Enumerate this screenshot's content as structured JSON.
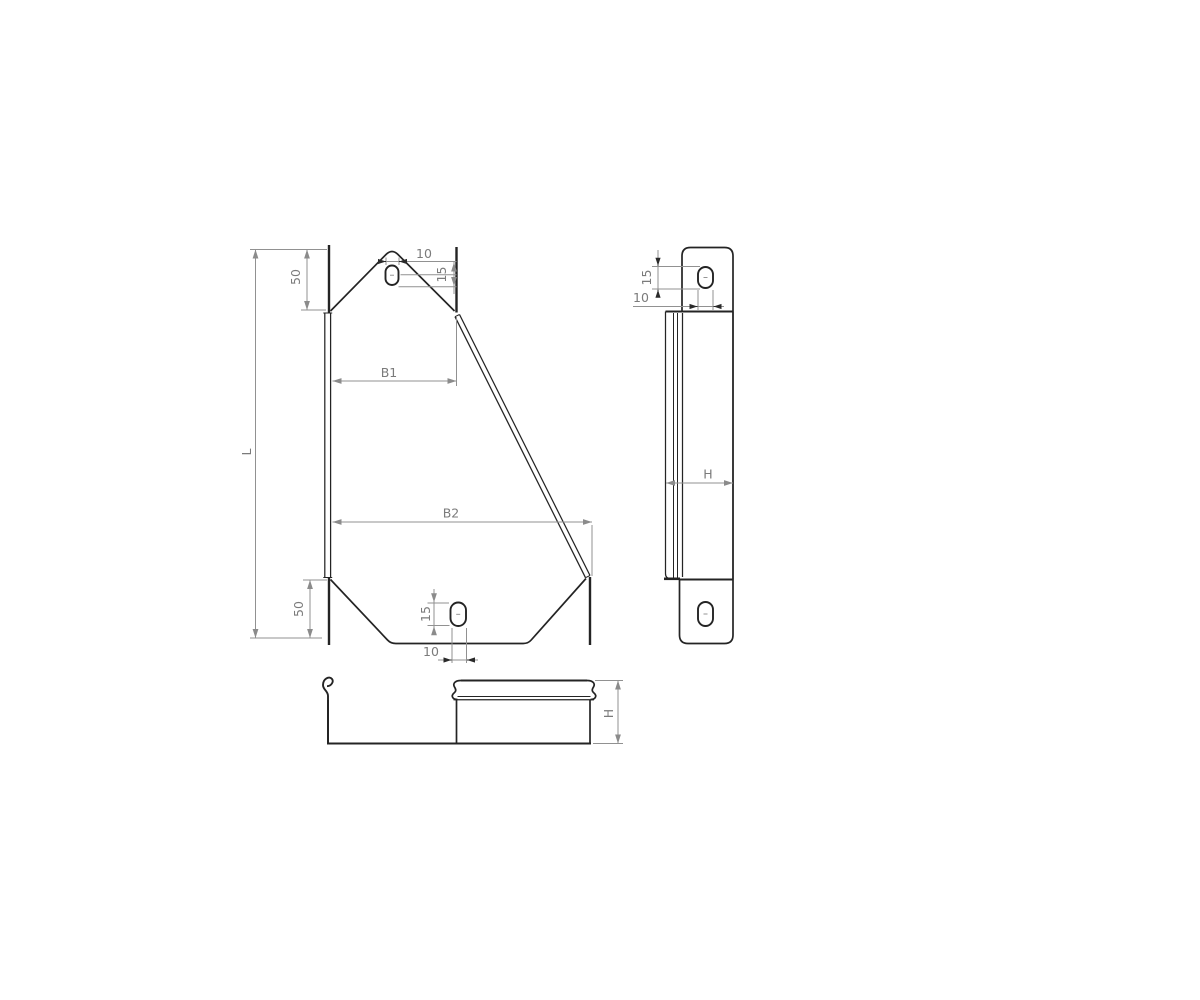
{
  "drawing_type": "technical-orthographic-views",
  "colors": {
    "background": "#ffffff",
    "part_edge": "#242424",
    "dimension_line": "#919191",
    "dimension_text": "#7b7b7b"
  },
  "front_view": {
    "length_label": "L",
    "top_offset_label": "50",
    "bottom_offset_label": "50",
    "top_width_label": "B1",
    "bottom_width_label": "B2",
    "top_slot_width_label": "10",
    "top_slot_height_label": "15",
    "bottom_slot_height_label": "15",
    "bottom_slot_width_label": "10"
  },
  "side_view": {
    "slot_height_label": "15",
    "slot_width_label": "10",
    "depth_label": "H"
  },
  "bottom_view": {
    "height_label": "H"
  }
}
